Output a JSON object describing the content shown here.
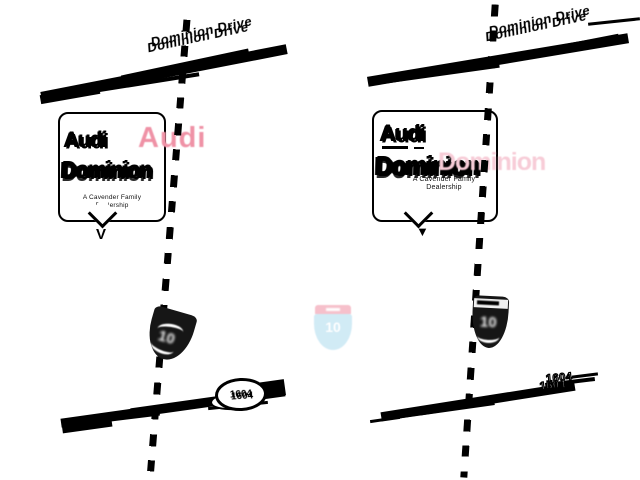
{
  "background": "#ffffff",
  "colors": {
    "road_black": "#000000",
    "audi_red_faded": "#ef92a6",
    "dominion_pink_faded": "#f7ccd7",
    "shield_dark": "#161616",
    "i10_band_faded": "#f6bdc9",
    "i10_body_faded": "#cfeaf5",
    "callout_bg": "#ffffff"
  },
  "panels": [
    {
      "side": "left",
      "street_label": "Dominion Drive",
      "callout": {
        "brand": "Audi",
        "brand_overlay": "Audi",
        "name": "Dominion",
        "tagline_line1": "A Cavender Family",
        "tagline_line2": "Dealership",
        "pointer_glyph": "V"
      },
      "interstate_route": "10",
      "loop_route": "1604"
    },
    {
      "side": "right",
      "street_label": "Dominion Drive",
      "callout": {
        "brand": "Audi",
        "name": "Dominion",
        "name_overlay": "Dominion",
        "tagline_line1": "A Cavender Family",
        "tagline_line2": "Dealership",
        "pointer_glyph": "▼"
      },
      "interstate_route": "10",
      "loop_route": "1604"
    }
  ],
  "center_shield": {
    "route": "10"
  }
}
